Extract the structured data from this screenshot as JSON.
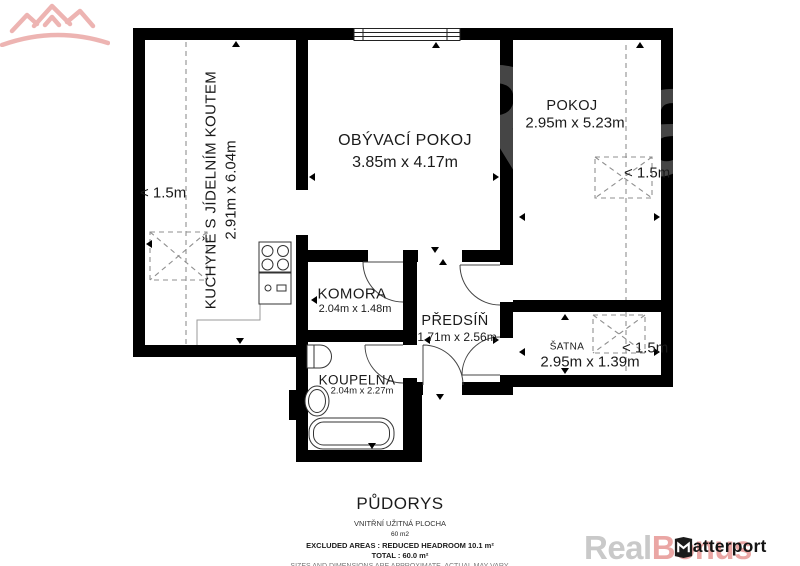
{
  "plan": {
    "rooms": [
      {
        "id": "kitchen",
        "name": "KUCHYNĚ S JÍDELNÍM KOUTEM",
        "dimensions": "2.91m x 6.04m"
      },
      {
        "id": "living-room",
        "name": "OBÝVACÍ POKOJ",
        "dimensions": "3.85m x 4.17m"
      },
      {
        "id": "bedroom",
        "name": "POKOJ",
        "dimensions": "2.95m x 5.23m"
      },
      {
        "id": "pantry",
        "name": "KOMORA",
        "dimensions": "2.04m x 1.48m"
      },
      {
        "id": "hallway",
        "name": "PŘEDSÍŇ",
        "dimensions": "1.71m x 2.56m"
      },
      {
        "id": "bathroom",
        "name": "KOUPELNA",
        "dimensions": "2.04m x 2.27m"
      },
      {
        "id": "closet",
        "name": "ŠATNA",
        "dimensions": "2.95m x 1.39m"
      }
    ],
    "headroom_labels": {
      "kitchen": "< 1.5m",
      "bedroom": "< 1.5m",
      "closet": "< 1.5m"
    }
  },
  "footer": {
    "title": "PŮDORYS",
    "subtitle": "VNITŘNÍ UŽITNÁ PLOCHA",
    "area": "60 m2",
    "excluded": "EXCLUDED AREAS :   REDUCED HEADROOM 10.1 m²",
    "total": "TOTAL :   60.0 m²",
    "disclaimer": "SIZES AND DIMENSIONS ARE APPROXIMATE, ACTUAL MAY VARY."
  },
  "branding": {
    "watermark_real": "Real",
    "watermark_bonus": "Bonus",
    "watermark_full": "RealBonus",
    "matterport": "Matterport",
    "colors": {
      "wall": "#000000",
      "watermark_gray": "#c9c9c9",
      "watermark_pink": "#eaa6a4"
    }
  }
}
